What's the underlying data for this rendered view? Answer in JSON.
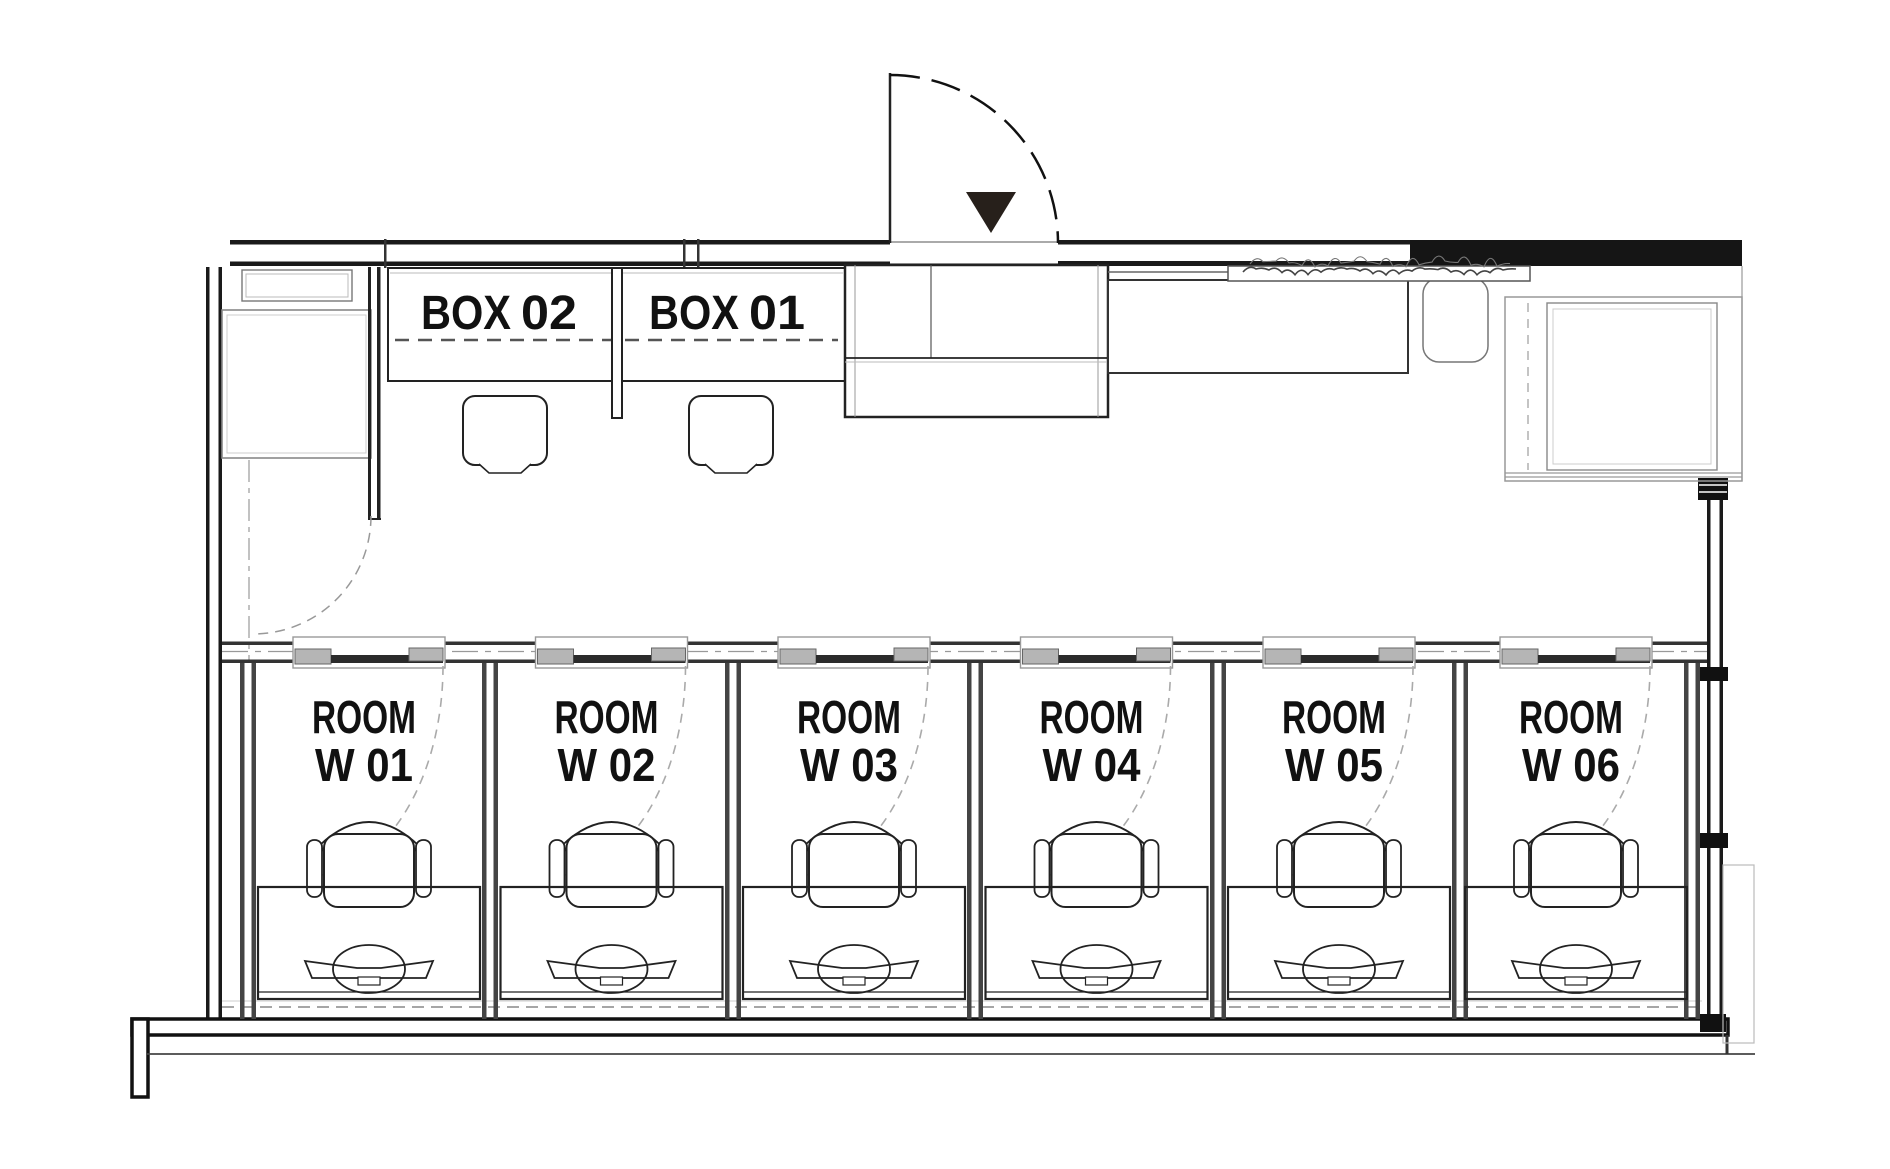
{
  "boxes": [
    {
      "prefix": "BOX",
      "number": "02"
    },
    {
      "prefix": "BOX",
      "number": "01"
    }
  ],
  "rooms": [
    {
      "name": "ROOM",
      "id": "W 01"
    },
    {
      "name": "ROOM",
      "id": "W 02"
    },
    {
      "name": "ROOM",
      "id": "W 03"
    },
    {
      "name": "ROOM",
      "id": "W 04"
    },
    {
      "name": "ROOM",
      "id": "W 05"
    },
    {
      "name": "ROOM",
      "id": "W 06"
    }
  ],
  "colors": {
    "ink": "#1a1a1a",
    "wall_fill": "#151515",
    "door_marker": "#27201b",
    "dash": "#999999",
    "light": "#bbbbbb"
  }
}
